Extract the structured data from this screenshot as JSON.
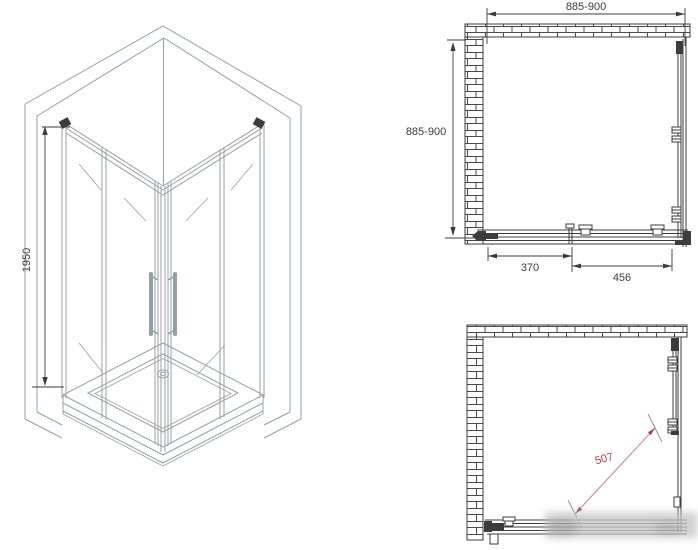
{
  "colors": {
    "background": "#ffffff",
    "line_light": "#9aa0a6",
    "line_dark": "#3c3c3c",
    "dimension_red": "#a8434b",
    "dimension_red_light": "#c98b90"
  },
  "view_3d": {
    "height_dimension": "1950"
  },
  "plan_top": {
    "top_dimension": "885-900",
    "left_dimension": "885-900",
    "bottom_left_dimension": "370",
    "bottom_right_dimension": "456"
  },
  "plan_bottom": {
    "diagonal_dimension": "507"
  }
}
